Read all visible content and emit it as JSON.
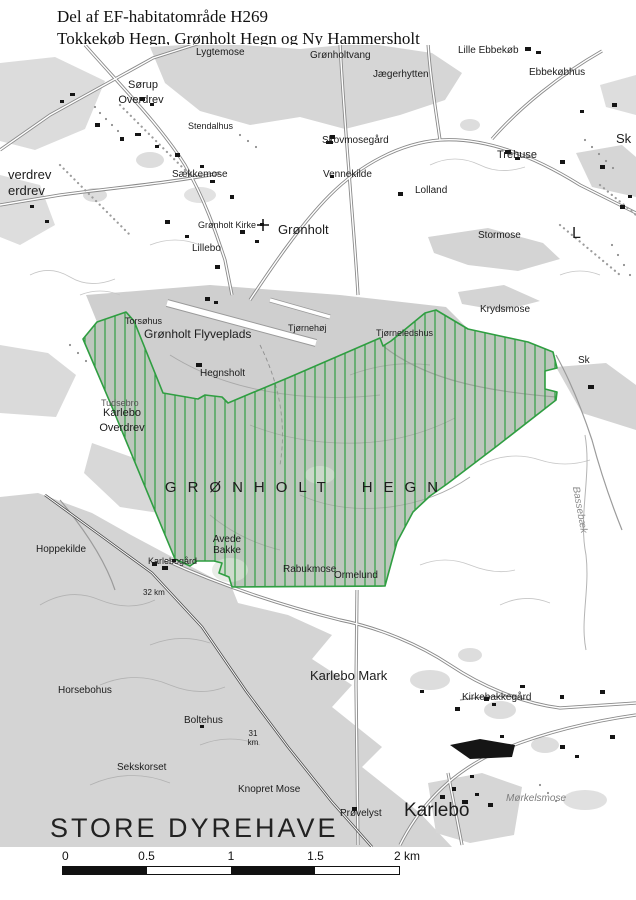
{
  "title": {
    "line1": "Del af EF-habitatområde H269",
    "line2": "Tokkekøb Hegn, Grønholt Hegn og Ny Hammersholt"
  },
  "map": {
    "habitat_name": "GRØNHOLT HEGN",
    "habitat_outline_color": "#2f9e41",
    "forest_color": "#d4d4d4",
    "labels": [
      {
        "t": "Lygtemose",
        "x": 196,
        "y": 3,
        "s": 10
      },
      {
        "t": "Grønholtvang",
        "x": 310,
        "y": 6,
        "s": 10
      },
      {
        "t": "Lille Ebbekøb",
        "x": 458,
        "y": 1,
        "s": 10
      },
      {
        "t": "Jægerhytten",
        "x": 373,
        "y": 25,
        "s": 10
      },
      {
        "t": "Ebbekøbhus",
        "x": 529,
        "y": 23,
        "s": 10
      },
      {
        "t": "Sørup",
        "x": 143,
        "y": 35,
        "s": 11,
        "a": "c"
      },
      {
        "t": "Overdrev",
        "x": 141,
        "y": 50,
        "s": 11,
        "a": "c"
      },
      {
        "t": "Stendalhus",
        "x": 188,
        "y": 77,
        "s": 9
      },
      {
        "t": "Skovmosegård",
        "x": 322,
        "y": 91,
        "s": 10
      },
      {
        "t": "Trehuse",
        "x": 497,
        "y": 105,
        "s": 11
      },
      {
        "t": "Sk",
        "x": 616,
        "y": 87,
        "s": 13
      },
      {
        "t": "Vennekilde",
        "x": 323,
        "y": 125,
        "s": 10
      },
      {
        "t": "Sækkemose",
        "x": 172,
        "y": 125,
        "s": 10
      },
      {
        "t": "Lolland",
        "x": 415,
        "y": 141,
        "s": 10
      },
      {
        "t": "verdrev",
        "x": 8,
        "y": 123,
        "s": 13
      },
      {
        "t": "erdrev",
        "x": 8,
        "y": 139,
        "s": 13
      },
      {
        "t": "Grønholt Kirke",
        "x": 198,
        "y": 176,
        "s": 9
      },
      {
        "t": "Grønholt",
        "x": 278,
        "y": 178,
        "s": 13
      },
      {
        "t": "Lillebo",
        "x": 192,
        "y": 199,
        "s": 10
      },
      {
        "t": "Stormose",
        "x": 478,
        "y": 186,
        "s": 10
      },
      {
        "t": "L",
        "x": 572,
        "y": 181,
        "s": 16
      },
      {
        "t": "Krydsmose",
        "x": 480,
        "y": 260,
        "s": 10
      },
      {
        "t": "Torsøhus",
        "x": 125,
        "y": 272,
        "s": 9
      },
      {
        "t": "Grønholt Flyveplads",
        "x": 144,
        "y": 283,
        "s": 12
      },
      {
        "t": "Tjørnehøj",
        "x": 288,
        "y": 279,
        "s": 9
      },
      {
        "t": "Tjørneledshus",
        "x": 376,
        "y": 284,
        "s": 9
      },
      {
        "t": "Hegnsholt",
        "x": 200,
        "y": 324,
        "s": 10
      },
      {
        "t": "Tudsebro",
        "x": 101,
        "y": 354,
        "s": 9,
        "c": "#555555"
      },
      {
        "t": "Karlebo",
        "x": 122,
        "y": 363,
        "s": 11,
        "a": "c"
      },
      {
        "t": "Overdrev",
        "x": 122,
        "y": 378,
        "s": 11,
        "a": "c"
      },
      {
        "t": "GRØNHOLT HEGN",
        "x": 307,
        "y": 435,
        "s": 15,
        "ls": 11,
        "ws": 10,
        "a": "c"
      },
      {
        "t": "Hoppekilde",
        "x": 36,
        "y": 500,
        "s": 10
      },
      {
        "t": "Avede",
        "x": 227,
        "y": 490,
        "s": 10,
        "a": "c"
      },
      {
        "t": "Bakke",
        "x": 227,
        "y": 501,
        "s": 10,
        "a": "c"
      },
      {
        "t": "Karlebogård",
        "x": 148,
        "y": 512,
        "s": 9
      },
      {
        "t": "Rabukmose",
        "x": 283,
        "y": 520,
        "s": 10
      },
      {
        "t": "Ormelund",
        "x": 334,
        "y": 526,
        "s": 10
      },
      {
        "t": "32 km",
        "x": 143,
        "y": 544,
        "s": 8
      },
      {
        "t": "Karlebo Mark",
        "x": 310,
        "y": 624,
        "s": 13
      },
      {
        "t": "Horsebohus",
        "x": 58,
        "y": 641,
        "s": 10
      },
      {
        "t": "Boltehus",
        "x": 184,
        "y": 671,
        "s": 10
      },
      {
        "t": "31",
        "x": 253,
        "y": 685,
        "s": 8,
        "a": "c"
      },
      {
        "t": "km",
        "x": 253,
        "y": 694,
        "s": 8,
        "a": "c"
      },
      {
        "t": "Sekskorset",
        "x": 117,
        "y": 718,
        "s": 10
      },
      {
        "t": "Knopret Mose",
        "x": 238,
        "y": 740,
        "s": 10
      },
      {
        "t": "Prøvelyst",
        "x": 340,
        "y": 764,
        "s": 10
      },
      {
        "t": "STORE DYREHAVE",
        "x": 50,
        "y": 770,
        "s": 27,
        "ls": 3,
        "c": "#222222"
      },
      {
        "t": "Karlebo",
        "x": 404,
        "y": 756,
        "s": 19
      },
      {
        "t": "Mørkelsmose",
        "x": 506,
        "y": 749,
        "s": 10,
        "i": true,
        "c": "#7d7d7d"
      },
      {
        "t": "Kirkebakkegård",
        "x": 462,
        "y": 648,
        "s": 10
      },
      {
        "t": "Bassebæk",
        "x": 579,
        "y": 460,
        "s": 10,
        "i": true,
        "c": "#8a8a8a",
        "a": "c",
        "r": 80
      },
      {
        "t": "Sk",
        "x": 578,
        "y": 311,
        "s": 10
      }
    ]
  },
  "scalebar": {
    "ticks": [
      "0",
      "0.5",
      "1",
      "1.5",
      "2 km"
    ]
  }
}
